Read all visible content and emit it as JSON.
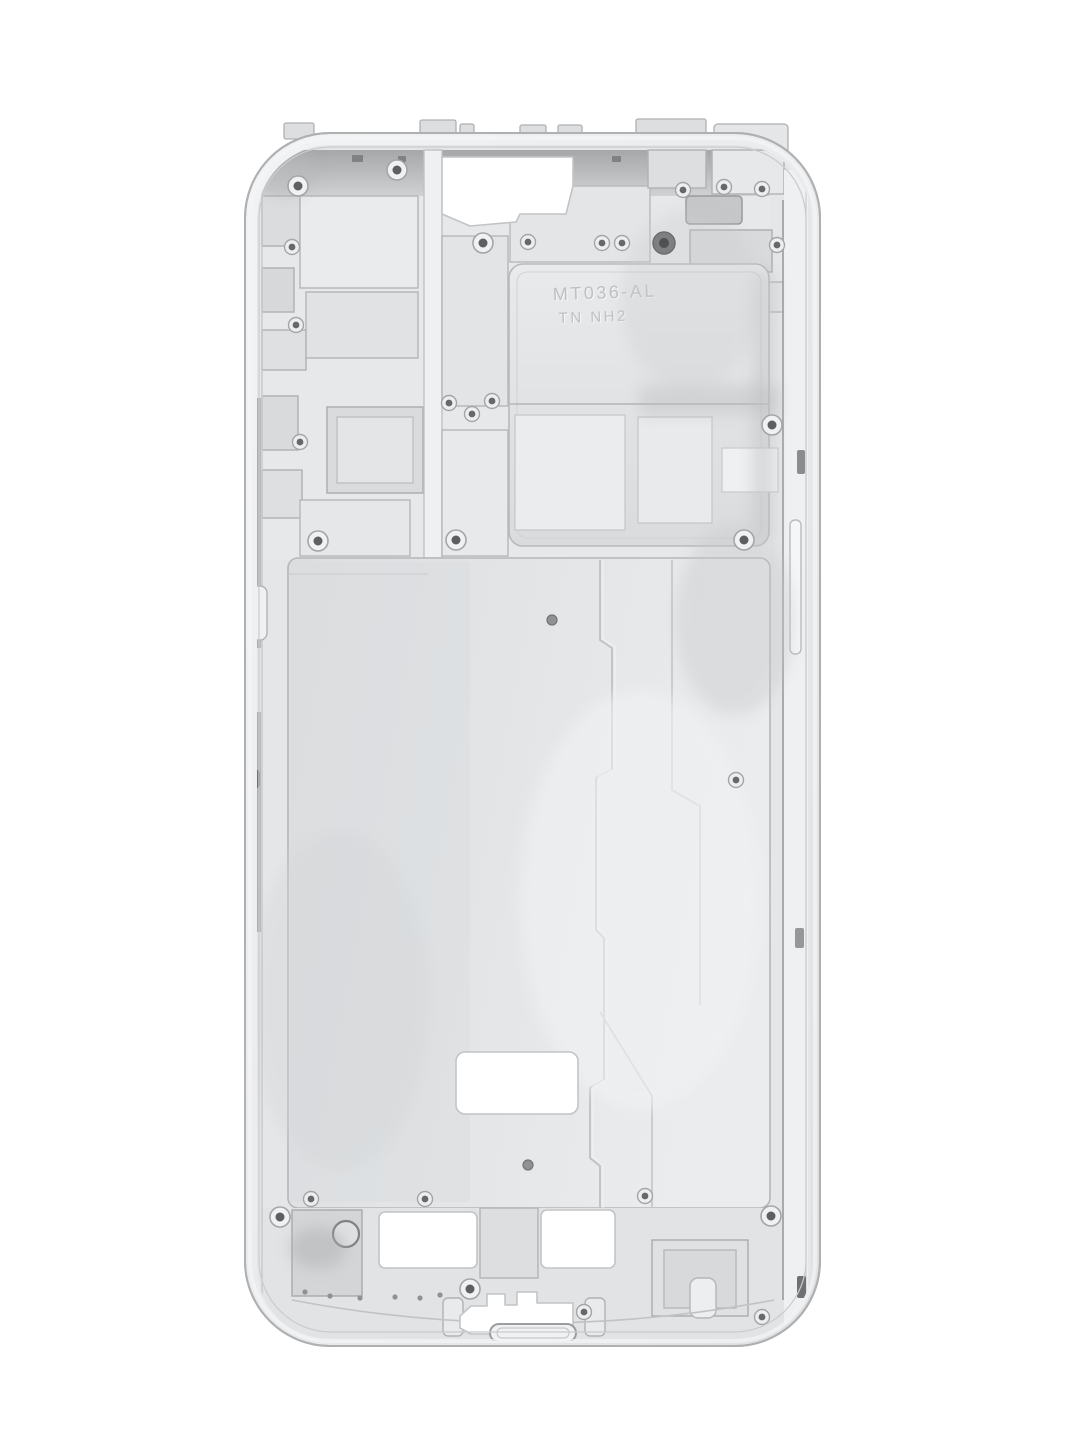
{
  "image": {
    "type": "photograph",
    "background_color": "#ffffff",
    "caption": "Silver die-cast smartphone mid-frame chassis, inner side, photographed on a white background",
    "width_px": 1080,
    "height_px": 1440
  },
  "part": {
    "kind": "phone-midframe-chassis",
    "finish": "matte silver die-cast metal with CNC machined pockets",
    "markings": {
      "line1": "MT036-AL",
      "line2": "TN NH2"
    },
    "colors": {
      "rim": "#f0f1f2",
      "body": "#e4e6e8",
      "pocket_light": "#eceeef",
      "pocket_dark": "#d6d8da",
      "dark_band": "#aaacae",
      "groove": "#8e9092",
      "screw_center": "#5d5f61",
      "cutout": "#ffffff",
      "outline": "#aeb0b2"
    },
    "features": [
      {
        "name": "antenna-tabs-top",
        "label": "small break tabs along the top edge"
      },
      {
        "name": "camera-earpiece-cutout",
        "label": "irregular white cut-out near the top"
      },
      {
        "name": "engraved-panel",
        "label": "large shielding pocket with engraved part number"
      },
      {
        "name": "vibration-motor-pocket",
        "label": "dark rectangular pocket, upper right"
      },
      {
        "name": "display-plate",
        "label": "large flat center plate with stepped seams"
      },
      {
        "name": "mid-plate-cutout",
        "label": "rounded rectangular cut-out in lower plate"
      },
      {
        "name": "speaker-cutout-left",
        "label": "bottom-left rectangular cut-out"
      },
      {
        "name": "speaker-cutout-right",
        "label": "bottom-right rectangular cut-out"
      },
      {
        "name": "usb-port-cutout",
        "label": "notched charging-port cut-out"
      },
      {
        "name": "charging-port-recess",
        "label": "stadium-shaped recess at bottom edge"
      },
      {
        "name": "bottom-round-hole",
        "label": "round hole at bottom left"
      },
      {
        "name": "volume-button-tab",
        "label": "button tab on the left rail"
      },
      {
        "name": "side-rail-left",
        "label": "left side rail with dark groove"
      },
      {
        "name": "side-rail-right",
        "label": "right side rail with button slot"
      },
      {
        "name": "screw-holes",
        "label": "screw bosses and pin holes",
        "count": 31
      }
    ]
  }
}
